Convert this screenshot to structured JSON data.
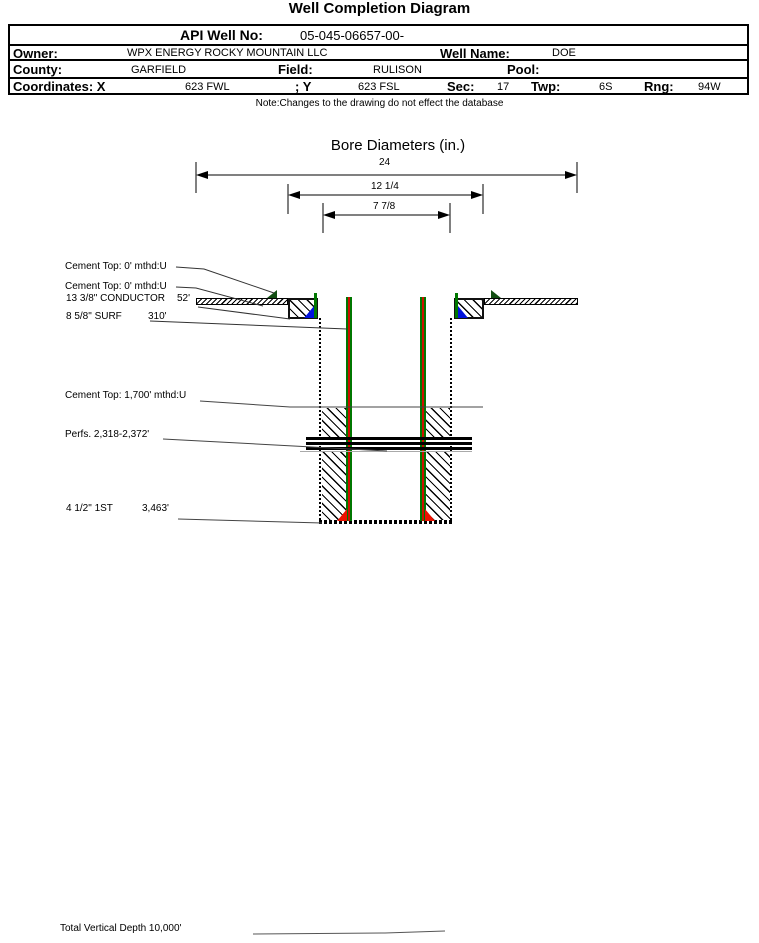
{
  "title": "Well Completion Diagram",
  "note": "Note:Changes to the drawing do not effect the database",
  "table": {
    "api_label": "API Well No:",
    "api_value": "05-045-06657-00-",
    "owner_label": "Owner:",
    "owner_value": "WPX ENERGY ROCKY MOUNTAIN LLC",
    "well_name_label": "Well Name:",
    "well_name_value": "DOE",
    "county_label": "County:",
    "county_value": "GARFIELD",
    "field_label": "Field:",
    "field_value": "RULISON",
    "pool_label": "Pool:",
    "pool_value": "",
    "coordinates_label": "Coordinates: X",
    "coord_x_value": "623 FWL",
    "coord_y_label": "; Y",
    "coord_y_value": "623 FSL",
    "sec_label": "Sec:",
    "sec_value": "17",
    "twp_label": "Twp:",
    "twp_value": "6S",
    "rng_label": "Rng:",
    "rng_value": "94W"
  },
  "bore": {
    "title": "Bore Diameters (in.)",
    "dims": [
      {
        "label": "24"
      },
      {
        "label": "12 1/4"
      },
      {
        "label": "7 7/8"
      }
    ]
  },
  "well": {
    "cement_top_conductor": "Cement Top: 0' mthd:U",
    "cement_top_surface": "Cement Top: 0' mthd:U",
    "conductor_label": "13 3/8\" CONDUCTOR",
    "conductor_depth": "52'",
    "surface_label": "8 5/8\" SURF",
    "surface_depth": "310'",
    "cement_top_production": "Cement Top: 1,700' mthd:U",
    "perfs_label": "Perfs. 2,318-2,372'",
    "production_label": "4 1/2\" 1ST",
    "production_depth": "3,463'",
    "tvd_label": "Total Vertical Depth 10,000'"
  },
  "colors": {
    "casing_red": "#cc1100",
    "casing_green": "#007700",
    "shoe_blue": "#0011dd",
    "marker_green": "#114d11",
    "shoe_red": "#ee1100"
  }
}
